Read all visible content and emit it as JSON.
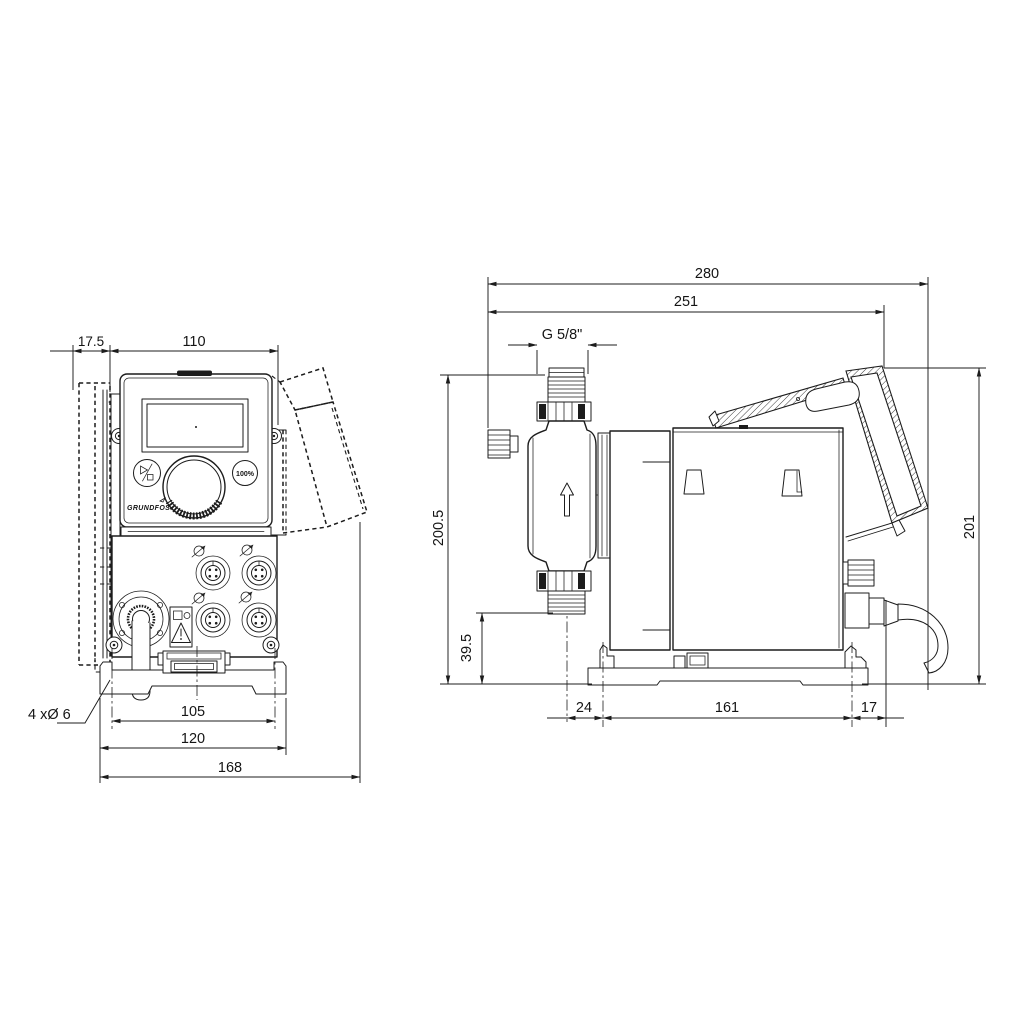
{
  "front": {
    "dim_offset": "17.5",
    "dim_width": "110",
    "dim_hole_spacing": "105",
    "dim_plate_width": "120",
    "dim_overall_width": "168",
    "holes_label": "4 xØ 6",
    "panel": {
      "max_button": "100%",
      "brand": "GRUNDFOS"
    }
  },
  "side": {
    "dim_depth_total": "280",
    "dim_depth_body": "251",
    "thread_label": "G 5/8\"",
    "dim_height_total": "200.5",
    "dim_valve_height": "39.5",
    "dim_front_offset": "24",
    "dim_base_length": "161",
    "dim_rear_offset": "17",
    "dim_height_rear": "201"
  },
  "colors": {
    "line": "#1c1c1c",
    "background": "#ffffff"
  }
}
